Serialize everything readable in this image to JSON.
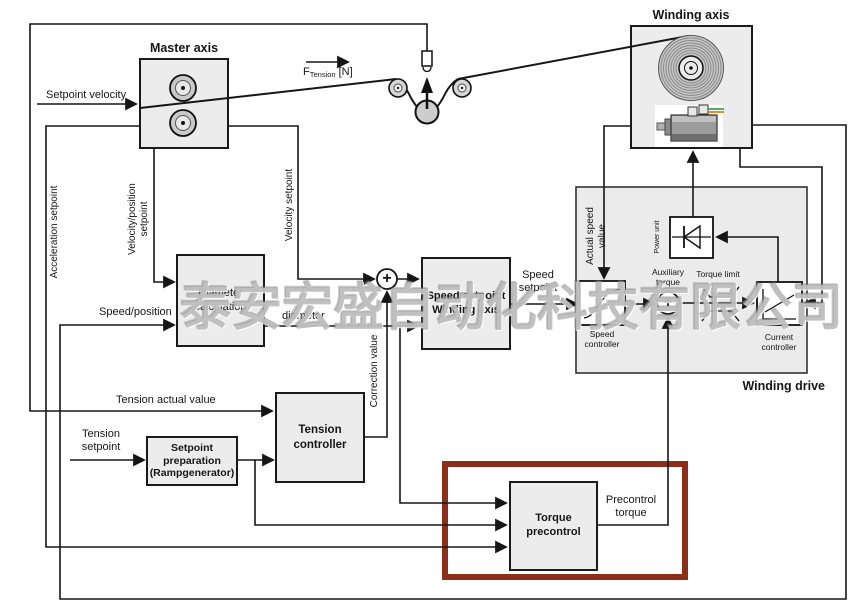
{
  "watermark": "泰安宏盛自动化科技有限公司",
  "colors": {
    "highlight_box": "#8b2f1b",
    "block_fill": "#ececec",
    "drive_fill": "#ebebeb",
    "line": "#161616",
    "wire_green": "#2e9b2e",
    "wire_orange": "#e07000"
  },
  "titles": {
    "master_axis": "Master axis",
    "winding_axis": "Winding axis",
    "winding_drive": "Winding drive"
  },
  "blocks": {
    "diameter_calculation": "Diameter\ncalculation",
    "speed_setpoint_winding_axis": "Speed setpoint\nWinding axis",
    "tension_controller": "Tension\ncontroller",
    "setpoint_preparation": "Setpoint\npreparation\n(Rampgenerator)",
    "torque_precontrol": "Torque\nprecontrol",
    "speed_controller": "Speed\ncontroller",
    "current_controller": "Current\ncontroller",
    "power_unit": "Power unit"
  },
  "labels": {
    "setpoint_velocity": "Setpoint velocity",
    "f_tension": {
      "base": "F",
      "sub": "Tension",
      "unit": "[N]"
    },
    "acceleration_setpoint": "Acceleration setpoint",
    "velocity_position_setpoint": "Velocity/position\nsetpoint",
    "velocity_setpoint": "Velocity setpoint",
    "speed_position": "Speed/position",
    "diameter": "diameter",
    "correction_value": "Correction value",
    "speed_setpoint": "Speed\nsetpoint",
    "tension_actual_value": "Tension actual value",
    "tension_setpoint": "Tension\nsetpoint",
    "precontrol_torque": "Precontrol\ntorque",
    "actual_speed_value": "Actual speed\nvalue",
    "auxiliary_torque": "Auxiliary\ntorque",
    "torque_limit": "Torque limit",
    "plus": "+"
  }
}
